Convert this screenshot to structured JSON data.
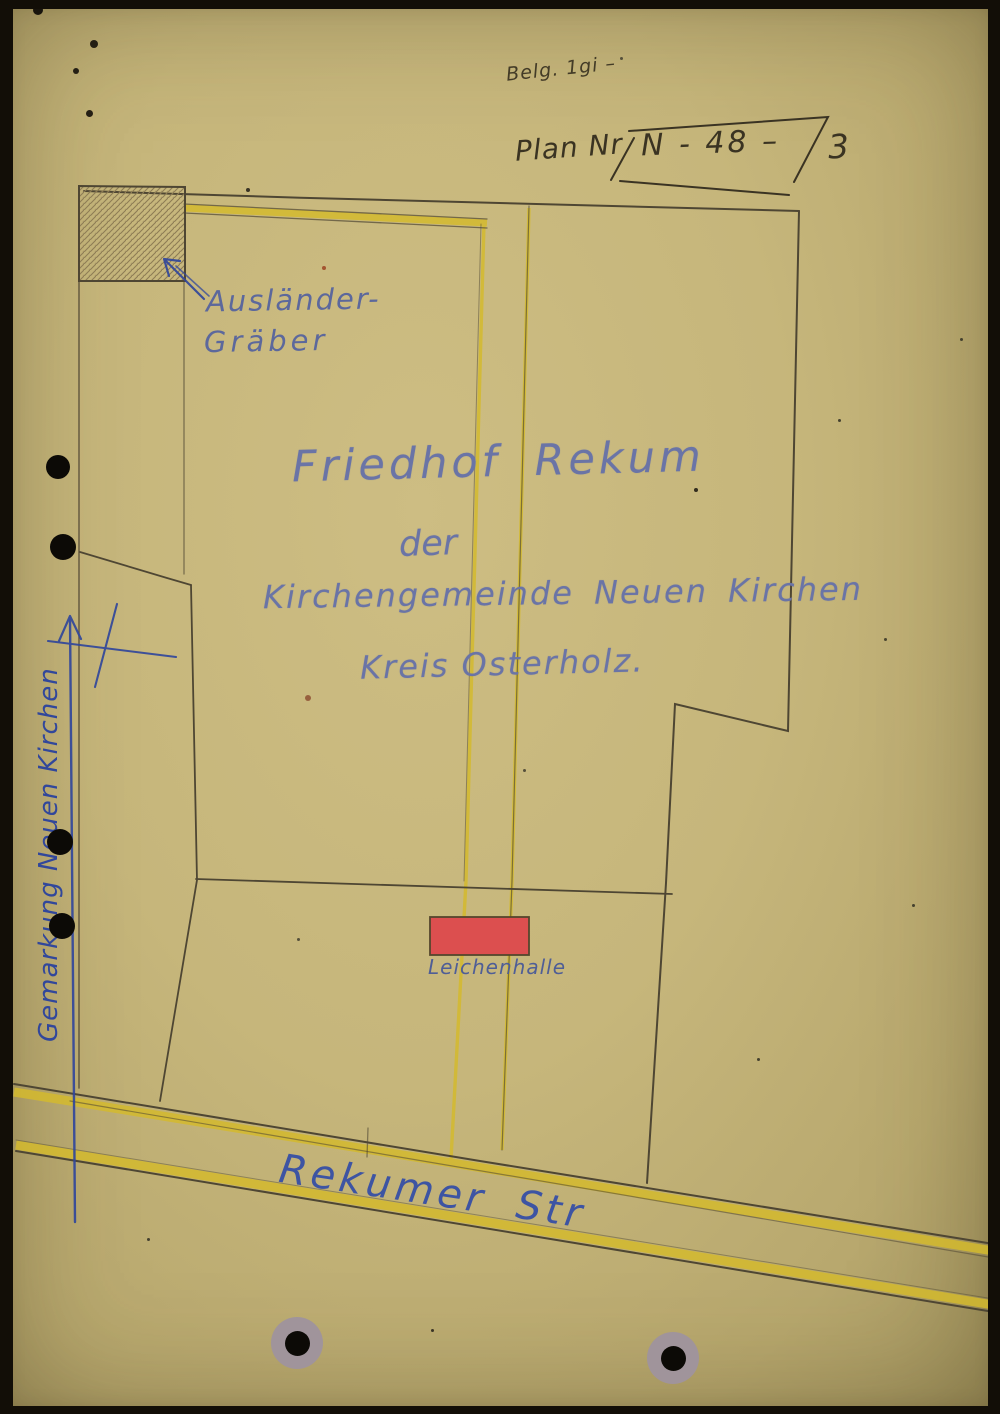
{
  "annotations": {
    "fee_note": "Belg. 1gi –",
    "plan": {
      "label": "Plan Nr",
      "number": "N - 48 –",
      "suffix": "3"
    },
    "foreign_graves": {
      "line1": "Ausländer-",
      "line2": "Gräber"
    },
    "title": {
      "line1": "Friedhof Rekum",
      "line2": "der",
      "line3": "Kirchengemeinde Neuen Kirchen",
      "line4": "Kreis Osterholz."
    },
    "mortuary": "Leichenhalle",
    "street": "Rekumer Str",
    "district": "Gemarkung Neuen Kirchen"
  },
  "colors": {
    "paper": "#c6b67b",
    "pencil": "#4e4633",
    "path_yellow": "#d4ba2e",
    "blue_ink": "#31479b",
    "blue_pencil": "#6a74a6",
    "mortuary_red": "#dc4f4f"
  }
}
